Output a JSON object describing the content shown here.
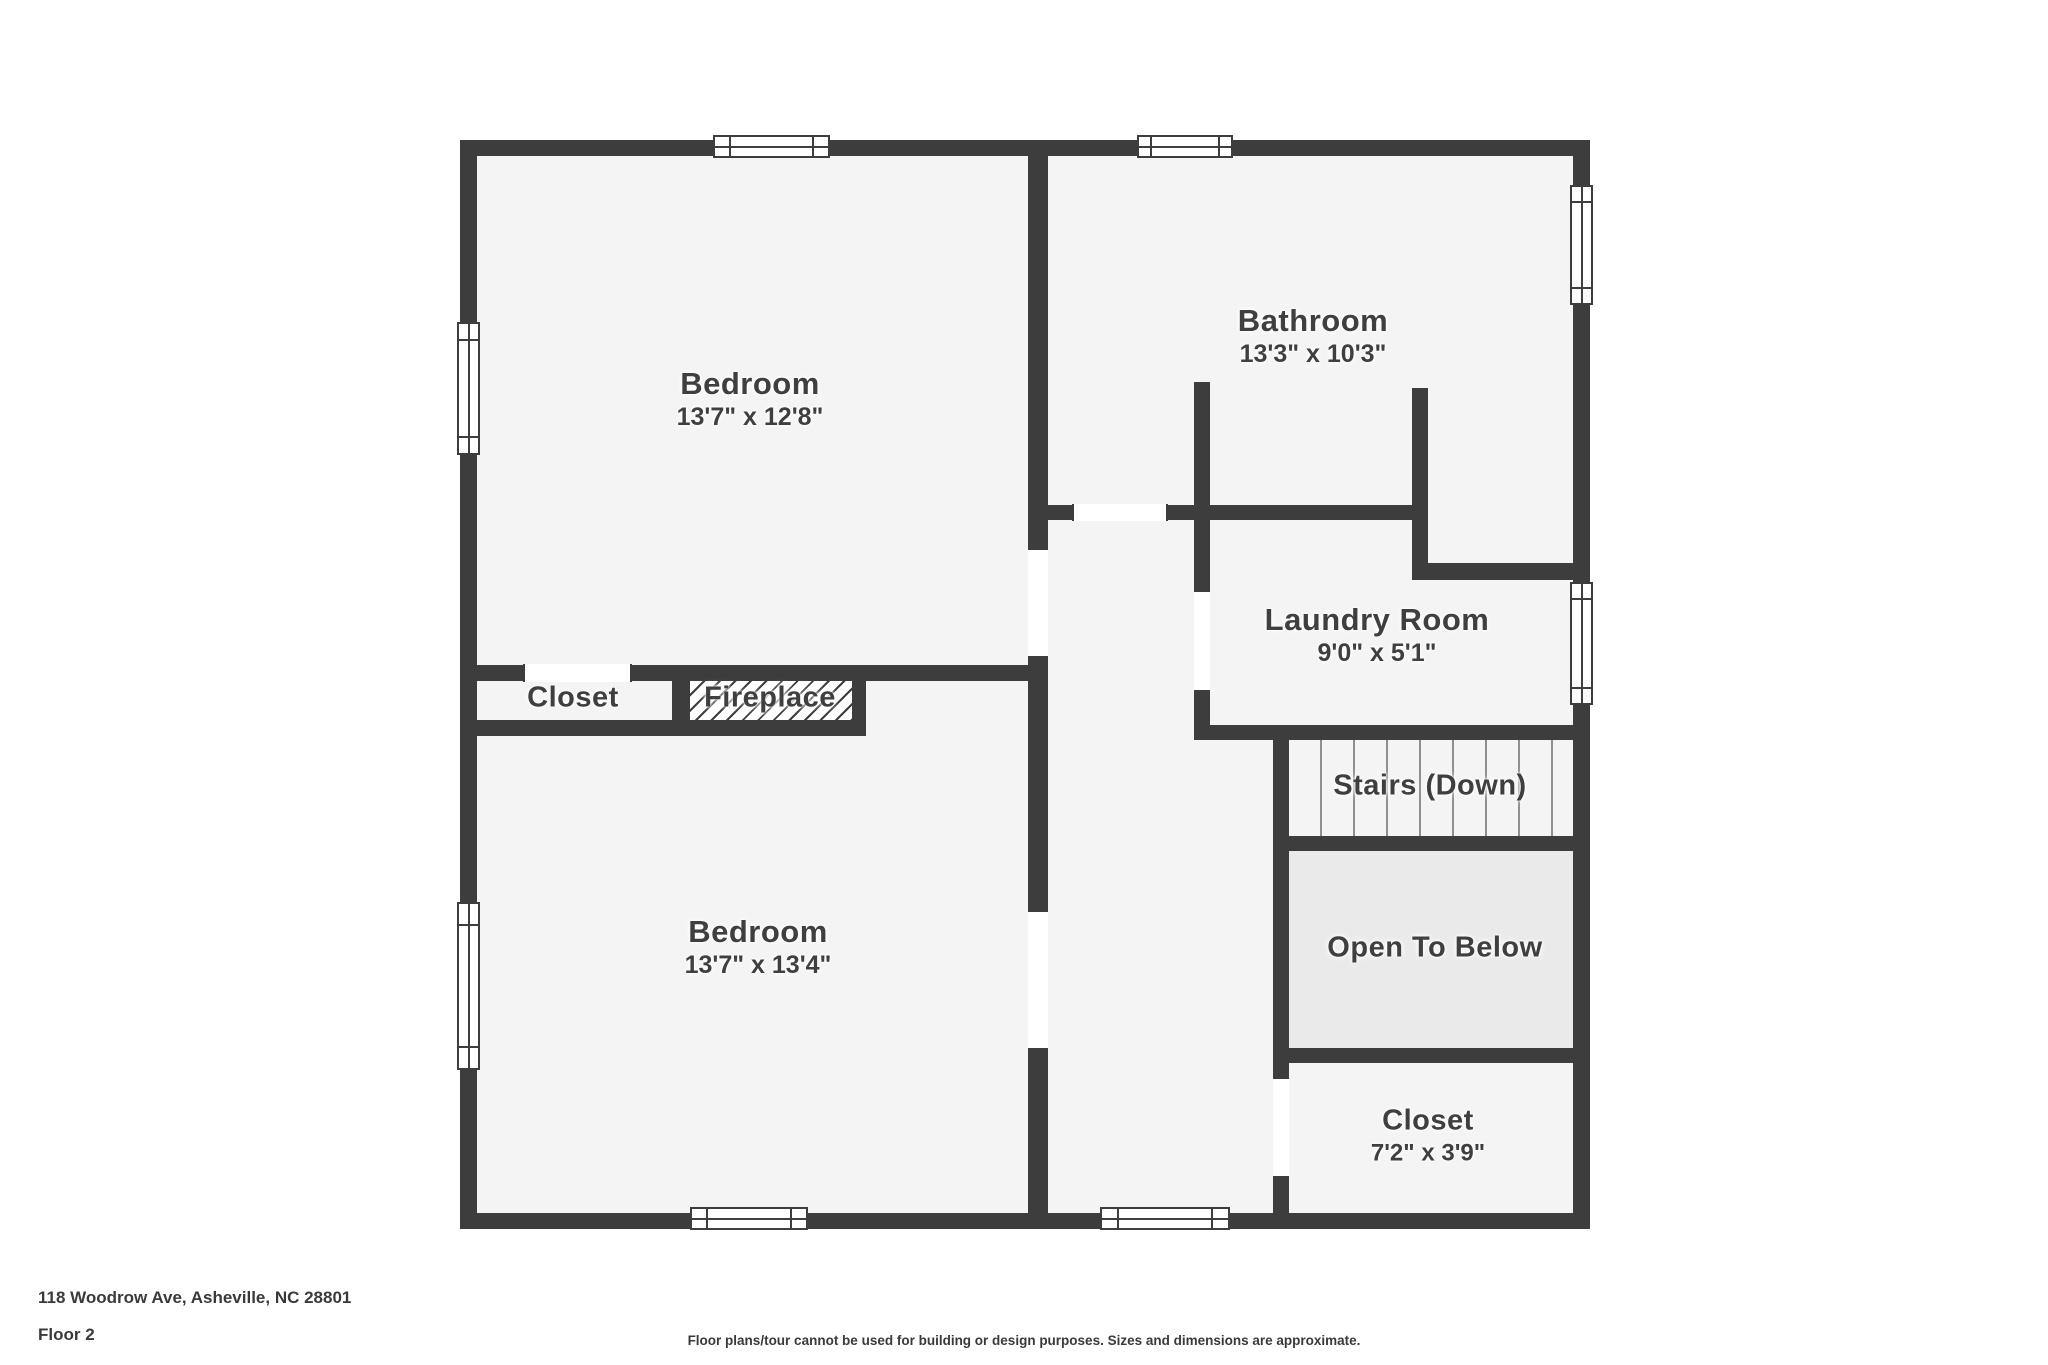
{
  "meta": {
    "address": "118 Woodrow Ave, Asheville, NC 28801",
    "floor_label": "Floor 2",
    "disclaimer": "Floor plans/tour cannot be used for building or design purposes. Sizes and dimensions are approximate."
  },
  "theme": {
    "wall_color": "#3d3d3d",
    "floor_color": "#f4f4f4",
    "open_to_below_fill": "#eaeaea",
    "page_background": "#ffffff",
    "label_color": "#3f3f3f",
    "stair_line_color": "#8f8f8f"
  },
  "rooms": {
    "bedroom_top": {
      "name": "Bedroom",
      "dimensions": "13'7\" x 12'8\""
    },
    "bathroom": {
      "name": "Bathroom",
      "dimensions": "13'3\" x 10'3\""
    },
    "laundry": {
      "name": "Laundry Room",
      "dimensions": "9'0\" x 5'1\""
    },
    "stairs": {
      "name": "Stairs (Down)"
    },
    "open_to_below": {
      "name": "Open To Below"
    },
    "closet_hall": {
      "name": "Closet",
      "dimensions": "7'2\" x 3'9\""
    },
    "bedroom_bottom": {
      "name": "Bedroom",
      "dimensions": "13'7\" x 13'4\""
    },
    "closet_band": {
      "name": "Closet"
    },
    "fireplace": {
      "name": "Fireplace"
    }
  }
}
